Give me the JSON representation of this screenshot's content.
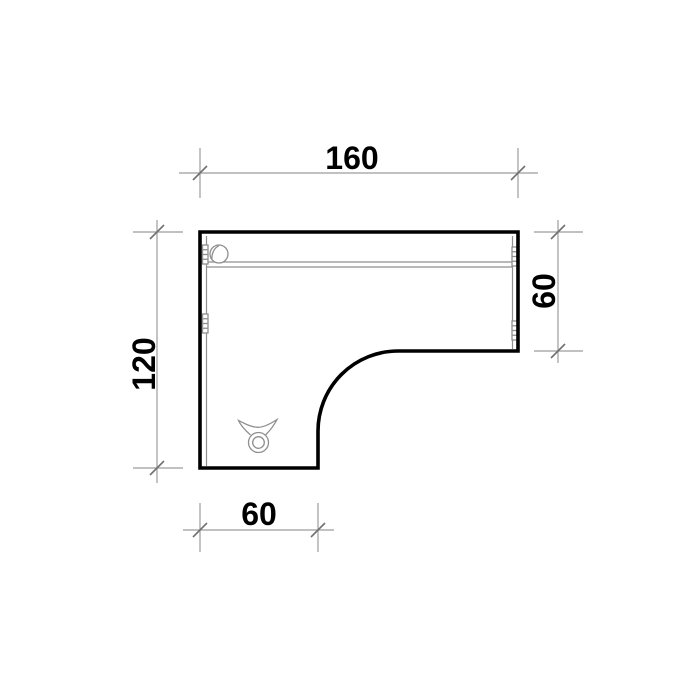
{
  "drawing": {
    "type": "technical-drawing",
    "subject": "L-shaped desk, top view plan with dimensions",
    "dimensions": {
      "top_width": "160",
      "left_height": "120",
      "right_depth": "60",
      "bottom_width": "60"
    },
    "icons": {
      "grommet": "grommet-icon",
      "hinge": "hinge-icon",
      "cable_clip": "cable-clip-icon"
    },
    "colors": {
      "bg": "#ffffff",
      "outline": "#000000",
      "dimline": "#9c9c9c",
      "tick": "#707070",
      "detail": "#8f8f8f",
      "text": "#000000"
    }
  }
}
